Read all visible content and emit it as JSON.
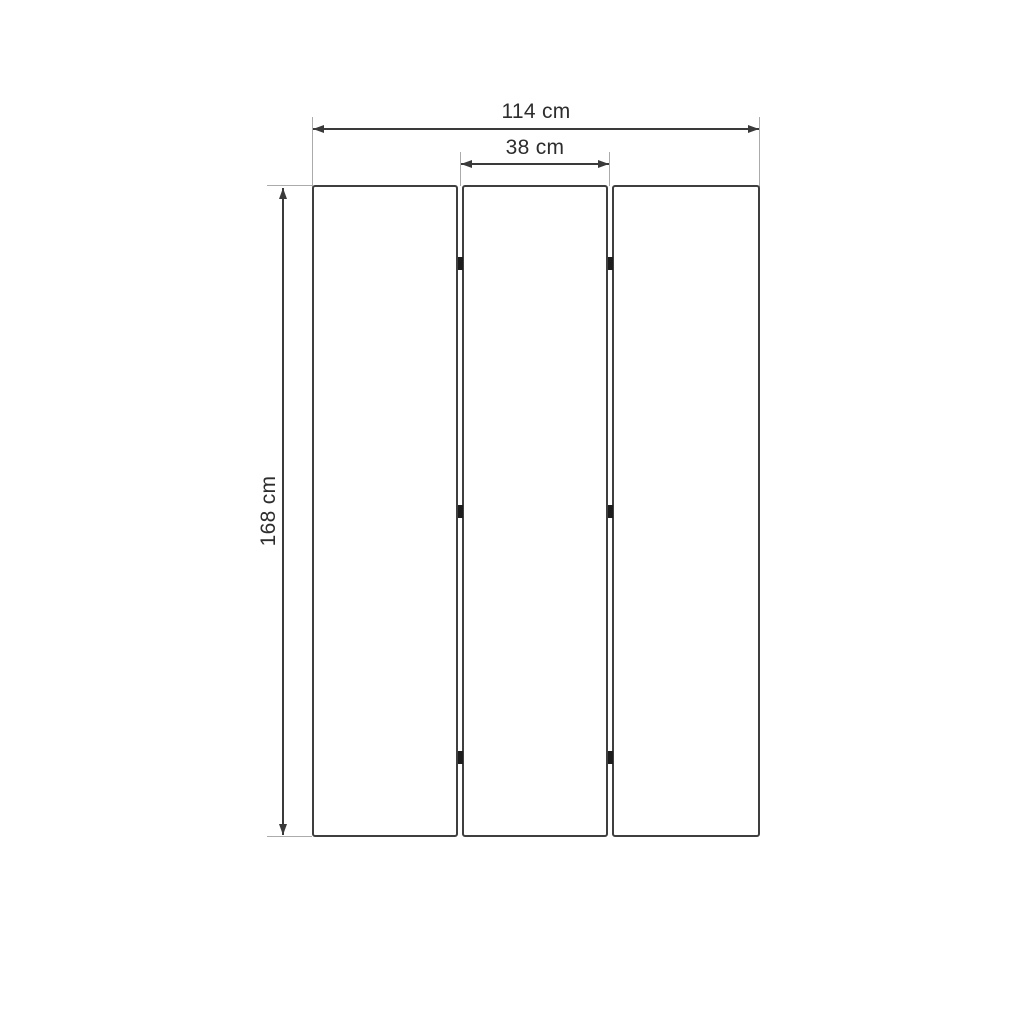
{
  "diagram": {
    "subject": "three-panel folding screen dimension drawing",
    "colors": {
      "background": "#ffffff",
      "panel_border": "#3f3f3f",
      "dimension_line": "#3a3a3a",
      "extension_line": "#ababab",
      "hinge": "#1d1d1d",
      "text": "#2d2d2d"
    },
    "panels": {
      "count": 3,
      "hinge_rows": 3
    },
    "dimensions": {
      "total_width_label": "114 cm",
      "panel_width_label": "38 cm",
      "height_label": "168 cm"
    }
  }
}
